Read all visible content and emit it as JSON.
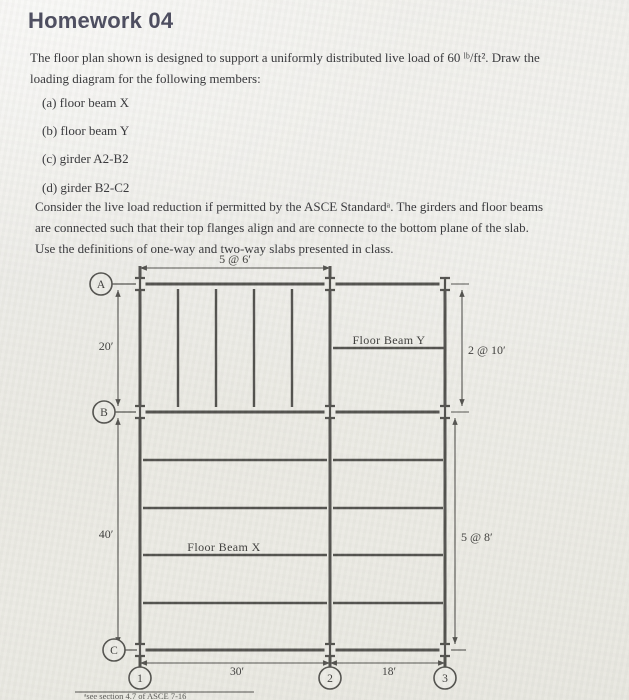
{
  "page": {
    "title": "Homework 04"
  },
  "intro": {
    "lines": [
      "The floor plan shown is designed to support a uniformly distributed live load of 60 ˡᵇ/ft². Draw the",
      "loading diagram for the following members:"
    ]
  },
  "items": [
    "(a) floor beam X",
    "(b) floor beam Y",
    "(c) girder A2-B2",
    "(d) girder B2-C2"
  ],
  "notes": {
    "lines": [
      "Consider the live load reduction if permitted by the ASCE Standardᵃ. The girders and floor beams",
      "are connected such that their top flanges align and are connecte to the bottom plane of the slab.",
      "Use the definitions of one-way and two-way slabs presented in class."
    ]
  },
  "diagram": {
    "dim_top": "5 @ 6′",
    "dim_left_top": "20′",
    "dim_left_bottom": "40′",
    "dim_right_top": "2 @ 10′",
    "dim_right_bottom": "5 @ 8′",
    "dim_bottom_left": "30′",
    "dim_bottom_right": "18′",
    "beam_y_label": "Floor Beam Y",
    "beam_x_label": "Floor Beam X",
    "grid_rows": [
      "A",
      "B",
      "C"
    ],
    "grid_cols": [
      "1",
      "2",
      "3"
    ],
    "footnote": "ᵃsee section 4.7 of ASCE 7-16",
    "colors": {
      "line": "#44433f",
      "text": "#2e2d2b"
    }
  }
}
